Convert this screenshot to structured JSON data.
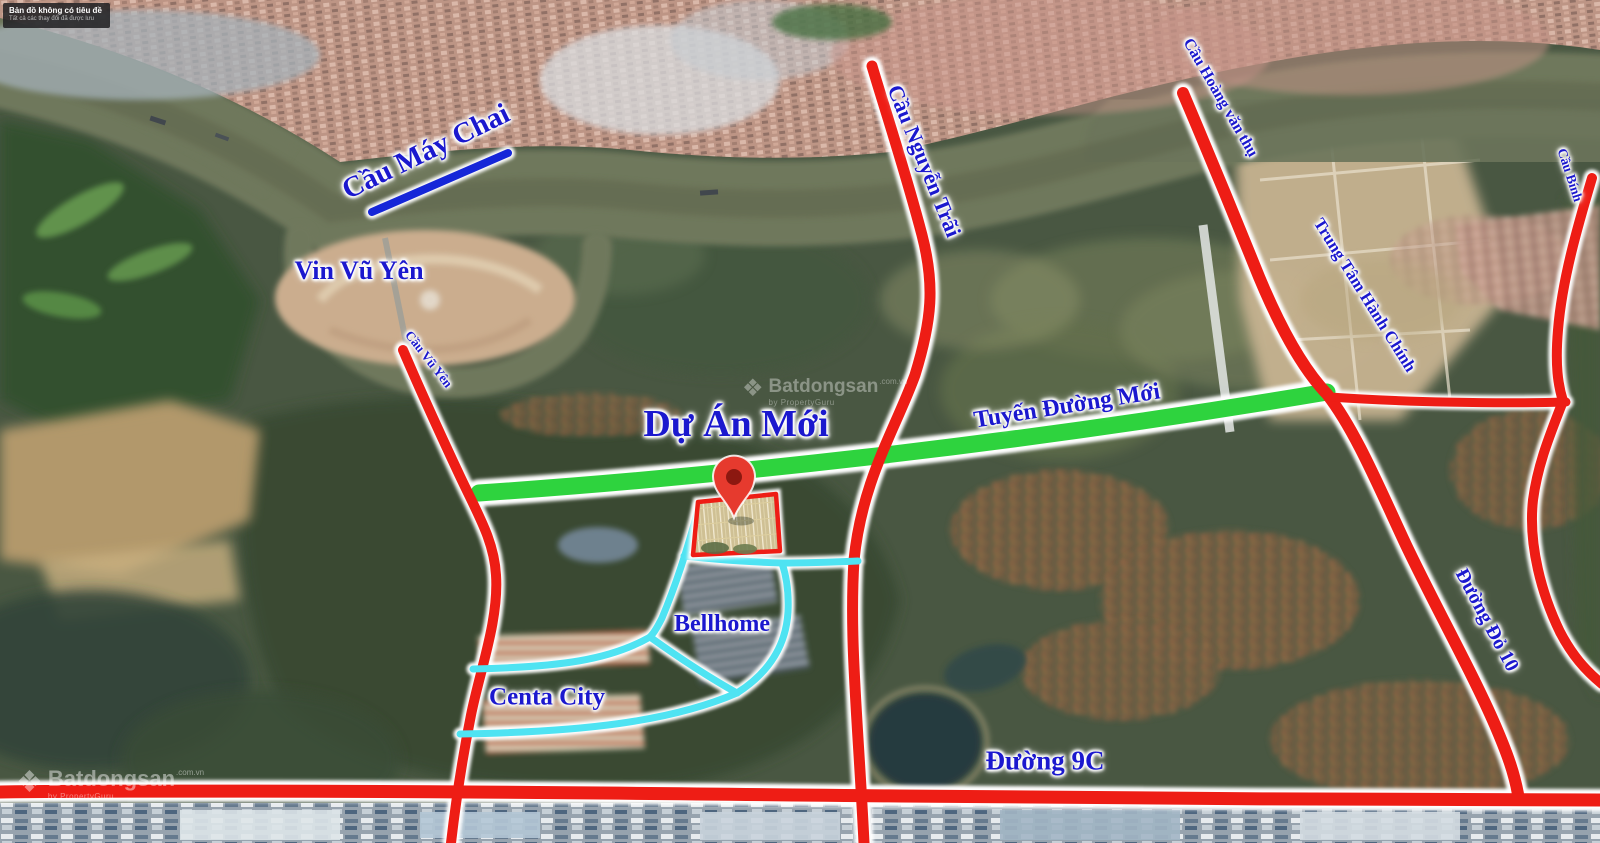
{
  "map_badge": {
    "title": "Bản đồ không có tiêu đề",
    "subtitle": "Tất cả các thay đổi đã được lưu"
  },
  "labels": {
    "cau_may_chai": "Cầu Máy Chai",
    "vin_vu_yen": "Vin Vũ Yên",
    "cau_vu_yen": "Cầu Vũ Yên",
    "du_an_moi": "Dự Án Mới",
    "tuyen_duong_moi": "Tuyến Đường Mới",
    "cau_nguyen_trai": "Cầu Nguyễn Trãi",
    "cau_hoang_van_thu": "Cầu Hoàng văn thụ",
    "trung_tam_hanh_chinh": "Trung Tâm Hành Chính",
    "cau_binh": "Cầu Bính",
    "duong_do_10": "Đường Đỏ 10",
    "bellhome": "Bellhome",
    "centa_city": "Centa City",
    "duong_9c": "Đường 9C"
  },
  "watermark": {
    "brand": "Batdongsan",
    "suffix": ".com.vn",
    "byline": "by PropertyGuru"
  },
  "colors": {
    "label-blue": "#1b18ce",
    "road-red": "#ee1d15",
    "road-green": "#2ed33e",
    "road-cyan": "#4fe3f2",
    "bridge-blue": "#1526d8",
    "marker-red": "#e63a2e",
    "marker-hole": "#8c1810"
  }
}
